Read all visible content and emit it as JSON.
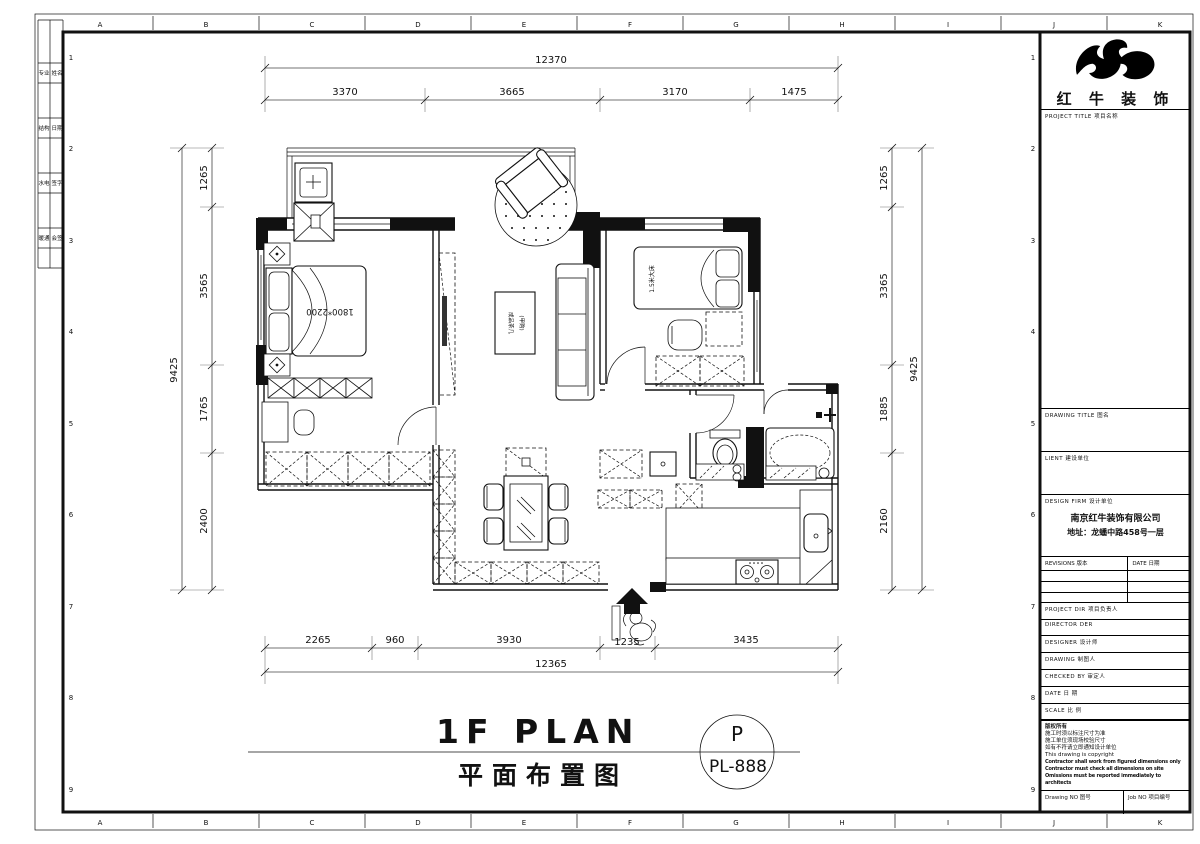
{
  "sheet": {
    "grid_letters": [
      "A",
      "B",
      "C",
      "D",
      "E",
      "F",
      "G",
      "H",
      "I",
      "J",
      "K"
    ],
    "grid_numbers": [
      "1",
      "2",
      "3",
      "4",
      "5",
      "6",
      "7",
      "8",
      "9"
    ],
    "signoff_cells": [
      [
        "专业",
        "姓名"
      ],
      [
        "结构",
        "日期"
      ],
      [
        "水电",
        "签字"
      ],
      [
        "暖通",
        "会签"
      ]
    ]
  },
  "plan": {
    "title_en": "1F PLAN",
    "title_cn": "平面布置图",
    "stamp_letter": "P",
    "stamp_code": "PL-888",
    "labels": {
      "master_bed": "1800*2200",
      "second_bed": "1.5米大床",
      "coffee_table_1": "成品茶几",
      "coffee_table_2": "(甲购)"
    },
    "dims": {
      "top_total": "12370",
      "top_seg": [
        "3370",
        "3665",
        "3170",
        "1475"
      ],
      "bottom_seg": [
        "2265",
        "960",
        "3930",
        "1235",
        "3435"
      ],
      "bottom_total": "12365",
      "left_total": "9425",
      "left_seg": [
        "1265",
        "3565",
        "1765",
        "2400"
      ],
      "right_seg": [
        "1265",
        "3365",
        "1885",
        "2160"
      ],
      "right_total": "9425"
    }
  },
  "title_block": {
    "brand": "红 牛 装 饰",
    "project_title": "PROJECT TITLE  项目名称",
    "drawing_title": "DRAWING TITLE  图名",
    "client": "LIENT  建设单位",
    "design_firm": "DESIGN FIRM  设计单位",
    "firm_name": "南京红牛装饰有限公司",
    "firm_addr": "地址：龙蟠中路458号一层",
    "revisions": "REVISIONS  版本",
    "date_col": "DATE  日期",
    "project_dir": "PROJECT DIR    项目负责人",
    "director": "DIRECTOR DER",
    "designer": "DESIGNER    设计师",
    "drawing_by": "DRAWING    制图人",
    "checked_by": "CHECKED BY   审定人",
    "date": "DATE    日 期",
    "scale": "SCALE    比 例",
    "copyright_lines": [
      "版权所有",
      "施工时须以标注尺寸为准",
      "施工单位须现场校验尺寸",
      "如有不符请立即通知设计单位",
      "This drawing is copyright"
    ],
    "copyright_bold": [
      "Contractor shall work from figured dimensions only",
      "Contractor must check all dimensions on site",
      "Omissions must be reported immediately to architects"
    ],
    "drawing_no": "Drawing NO  图号",
    "job_no": "Job NO  项目编号"
  }
}
